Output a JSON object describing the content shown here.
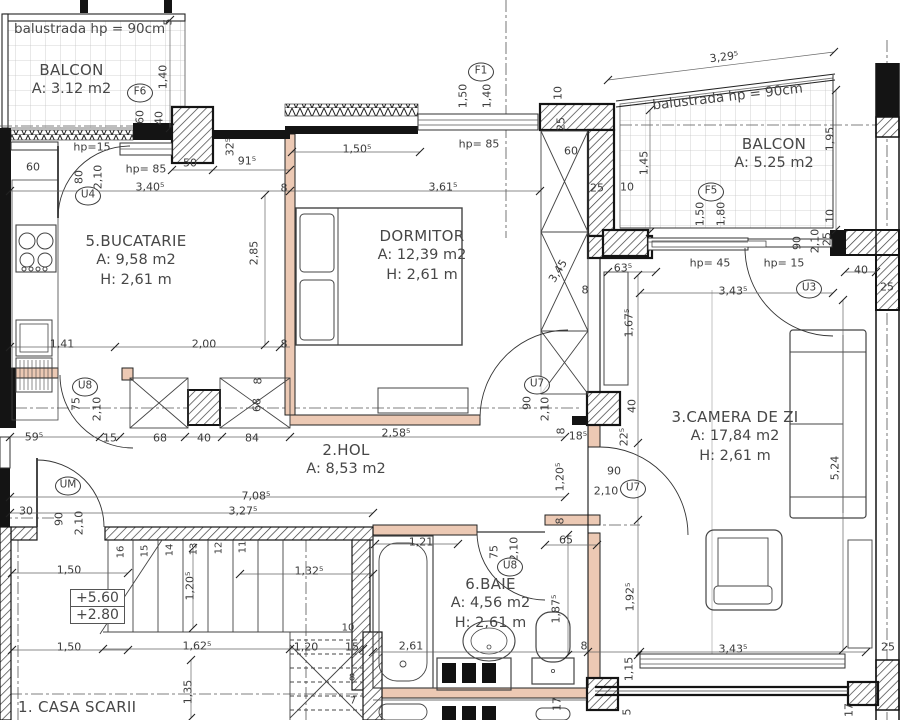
{
  "rooms": [
    {
      "name": "BALCON",
      "area": "A: 3.12 m2"
    },
    {
      "name": "5.BUCATARIE",
      "area": "A: 9,58 m2",
      "height": "H: 2,61 m"
    },
    {
      "name": "DORMITOR",
      "area": "A: 12,39 m2",
      "height": "H: 2,61 m"
    },
    {
      "name": "BALCON",
      "area": "A: 5.25 m2"
    },
    {
      "name": "3.CAMERA DE ZI",
      "area": "A: 17,84 m2",
      "height": "H: 2,61 m"
    },
    {
      "name": "2.HOL",
      "area": "A: 8,53 m2"
    },
    {
      "name": "6.BAIE",
      "area": "A: 4,56 m2",
      "height": "H: 2,61 m"
    },
    {
      "name": "1. CASA SCARII"
    }
  ],
  "notes": {
    "balustrade_left": "balustrada hp = 90cm",
    "balustrade_right": "balustrada hp = 90cm"
  },
  "levels": {
    "upper": "+5.60",
    "lower": "+2.80"
  },
  "openings": [
    {
      "t": "F6",
      "x": 140,
      "y": 93
    },
    {
      "t": "F1",
      "x": 481,
      "y": 72
    },
    {
      "t": "F5",
      "x": 711,
      "y": 192
    },
    {
      "t": "U4",
      "x": 88,
      "y": 196
    },
    {
      "t": "U8",
      "x": 85,
      "y": 387
    },
    {
      "t": "UM",
      "x": 68,
      "y": 486
    },
    {
      "t": "U7",
      "x": 537,
      "y": 385
    },
    {
      "t": "U8",
      "x": 510,
      "y": 567
    },
    {
      "t": "U7",
      "x": 633,
      "y": 489
    },
    {
      "t": "U3",
      "x": 809,
      "y": 289
    }
  ],
  "stair_numbers": [
    {
      "t": "16",
      "x": 121,
      "y": 552,
      "v": 1
    },
    {
      "t": "15",
      "x": 145,
      "y": 551,
      "v": 1
    },
    {
      "t": "14",
      "x": 170,
      "y": 550,
      "v": 1
    },
    {
      "t": "13",
      "x": 194,
      "y": 549,
      "v": 1
    },
    {
      "t": "12",
      "x": 219,
      "y": 548,
      "v": 1
    },
    {
      "t": "11",
      "x": 243,
      "y": 547,
      "v": 1
    },
    {
      "t": "10",
      "x": 348,
      "y": 628
    },
    {
      "t": "8",
      "x": 352,
      "y": 678
    },
    {
      "t": "7",
      "x": 353,
      "y": 701
    }
  ],
  "dims": [
    {
      "t": "5",
      "x": 168,
      "y": 22,
      "v": 1
    },
    {
      "t": "1,40",
      "x": 163,
      "y": 77,
      "v": 1
    },
    {
      "t": "60",
      "x": 140,
      "y": 117,
      "v": 1
    },
    {
      "t": "40",
      "x": 159,
      "y": 118,
      "v": 1
    },
    {
      "t": "hp=15",
      "x": 92,
      "y": 147
    },
    {
      "t": "60",
      "x": 33,
      "y": 167
    },
    {
      "t": "80",
      "x": 79,
      "y": 177,
      "v": 1
    },
    {
      "t": "2,10",
      "x": 98,
      "y": 177,
      "v": 1
    },
    {
      "t": "hp= 85",
      "x": 146,
      "y": 169
    },
    {
      "t": "3,40⁵",
      "x": 150,
      "y": 187
    },
    {
      "t": "50",
      "x": 190,
      "y": 163
    },
    {
      "t": "91⁵",
      "x": 247,
      "y": 161
    },
    {
      "t": "32⁵",
      "x": 230,
      "y": 147,
      "v": 1
    },
    {
      "t": "8",
      "x": 284,
      "y": 188
    },
    {
      "t": "1,50⁵",
      "x": 357,
      "y": 149
    },
    {
      "t": "3,61⁵",
      "x": 443,
      "y": 187
    },
    {
      "t": "1,50",
      "x": 463,
      "y": 96,
      "v": 1
    },
    {
      "t": "1,40",
      "x": 487,
      "y": 96,
      "v": 1
    },
    {
      "t": "hp= 85",
      "x": 479,
      "y": 144
    },
    {
      "t": "10",
      "x": 558,
      "y": 93,
      "v": 1
    },
    {
      "t": "25",
      "x": 561,
      "y": 124,
      "v": 1
    },
    {
      "t": "60",
      "x": 571,
      "y": 151
    },
    {
      "t": "25",
      "x": 597,
      "y": 188
    },
    {
      "t": "10",
      "x": 627,
      "y": 187
    },
    {
      "t": "1,45",
      "x": 644,
      "y": 163,
      "v": 1
    },
    {
      "t": "3,45",
      "x": 558,
      "y": 271,
      "d": -58
    },
    {
      "t": "8",
      "x": 585,
      "y": 290
    },
    {
      "t": "2,85",
      "x": 254,
      "y": 253,
      "v": 1
    },
    {
      "t": "1,41",
      "x": 62,
      "y": 344
    },
    {
      "t": "2,00",
      "x": 204,
      "y": 344
    },
    {
      "t": "8",
      "x": 284,
      "y": 344
    },
    {
      "t": "3,29⁵",
      "x": 724,
      "y": 57,
      "d": -7
    },
    {
      "t": "1,95",
      "x": 830,
      "y": 139,
      "v": 1
    },
    {
      "t": "1,50",
      "x": 700,
      "y": 214,
      "v": 1
    },
    {
      "t": "1,80",
      "x": 721,
      "y": 214,
      "v": 1
    },
    {
      "t": "10",
      "x": 830,
      "y": 216,
      "v": 1
    },
    {
      "t": "25",
      "x": 827,
      "y": 239,
      "v": 1
    },
    {
      "t": "hp= 45",
      "x": 710,
      "y": 263
    },
    {
      "t": "hp= 15",
      "x": 784,
      "y": 263
    },
    {
      "t": "90",
      "x": 797,
      "y": 243,
      "v": 1
    },
    {
      "t": "2,10",
      "x": 815,
      "y": 241,
      "v": 1
    },
    {
      "t": "40",
      "x": 861,
      "y": 270
    },
    {
      "t": "25",
      "x": 887,
      "y": 287
    },
    {
      "t": "3,43⁵",
      "x": 733,
      "y": 291
    },
    {
      "t": "63⁵",
      "x": 623,
      "y": 268
    },
    {
      "t": "1,67⁵",
      "x": 629,
      "y": 323,
      "v": 1
    },
    {
      "t": "40",
      "x": 632,
      "y": 406,
      "v": 1
    },
    {
      "t": "22⁵",
      "x": 624,
      "y": 437,
      "v": 1
    },
    {
      "t": "5,24",
      "x": 835,
      "y": 468,
      "v": 1
    },
    {
      "t": "1,92⁵",
      "x": 630,
      "y": 597,
      "v": 1
    },
    {
      "t": "3,43⁵",
      "x": 733,
      "y": 649
    },
    {
      "t": "25",
      "x": 888,
      "y": 647
    },
    {
      "t": "1,15",
      "x": 629,
      "y": 669,
      "v": 1
    },
    {
      "t": "5",
      "x": 627,
      "y": 712,
      "v": 1
    },
    {
      "t": "17",
      "x": 849,
      "y": 710,
      "v": 1
    },
    {
      "t": "17",
      "x": 557,
      "y": 704,
      "v": 1
    },
    {
      "t": "90",
      "x": 527,
      "y": 403,
      "v": 1
    },
    {
      "t": "2,10",
      "x": 545,
      "y": 409,
      "v": 1
    },
    {
      "t": "18⁵",
      "x": 578,
      "y": 436
    },
    {
      "t": "8",
      "x": 561,
      "y": 431,
      "v": 1
    },
    {
      "t": "1,20⁵",
      "x": 560,
      "y": 477,
      "v": 1
    },
    {
      "t": "90",
      "x": 614,
      "y": 471
    },
    {
      "t": "2,10",
      "x": 606,
      "y": 491
    },
    {
      "t": "15",
      "x": 110,
      "y": 438
    },
    {
      "t": "68",
      "x": 160,
      "y": 438
    },
    {
      "t": "40",
      "x": 204,
      "y": 438
    },
    {
      "t": "84",
      "x": 252,
      "y": 438
    },
    {
      "t": "2,58⁵",
      "x": 396,
      "y": 433
    },
    {
      "t": "8",
      "x": 258,
      "y": 381,
      "v": 1
    },
    {
      "t": "68",
      "x": 257,
      "y": 405,
      "v": 1
    },
    {
      "t": "59⁵",
      "x": 34,
      "y": 437
    },
    {
      "t": "75",
      "x": 76,
      "y": 404,
      "v": 1
    },
    {
      "t": "2,10",
      "x": 97,
      "y": 409,
      "v": 1
    },
    {
      "t": "30",
      "x": 26,
      "y": 511
    },
    {
      "t": "90",
      "x": 59,
      "y": 519,
      "v": 1
    },
    {
      "t": "2,10",
      "x": 79,
      "y": 523,
      "v": 1
    },
    {
      "t": "7,08⁵",
      "x": 256,
      "y": 496
    },
    {
      "t": "3,27⁵",
      "x": 243,
      "y": 511
    },
    {
      "t": "1,50",
      "x": 69,
      "y": 570
    },
    {
      "t": "1,50",
      "x": 69,
      "y": 647
    },
    {
      "t": "1,32⁵",
      "x": 309,
      "y": 571
    },
    {
      "t": "1,20⁵",
      "x": 190,
      "y": 586,
      "v": 1
    },
    {
      "t": "1,62⁵",
      "x": 197,
      "y": 646
    },
    {
      "t": "1,20",
      "x": 306,
      "y": 647
    },
    {
      "t": "15",
      "x": 352,
      "y": 647
    },
    {
      "t": "1,35",
      "x": 188,
      "y": 692,
      "v": 1
    },
    {
      "t": "1,21",
      "x": 421,
      "y": 542
    },
    {
      "t": "75",
      "x": 494,
      "y": 552,
      "v": 1
    },
    {
      "t": "2,10",
      "x": 514,
      "y": 549,
      "v": 1
    },
    {
      "t": "8",
      "x": 560,
      "y": 521,
      "v": 1
    },
    {
      "t": "65",
      "x": 566,
      "y": 540
    },
    {
      "t": "1,87⁵",
      "x": 556,
      "y": 609,
      "v": 1
    },
    {
      "t": "2,61",
      "x": 411,
      "y": 646
    },
    {
      "t": "8",
      "x": 584,
      "y": 646
    }
  ]
}
